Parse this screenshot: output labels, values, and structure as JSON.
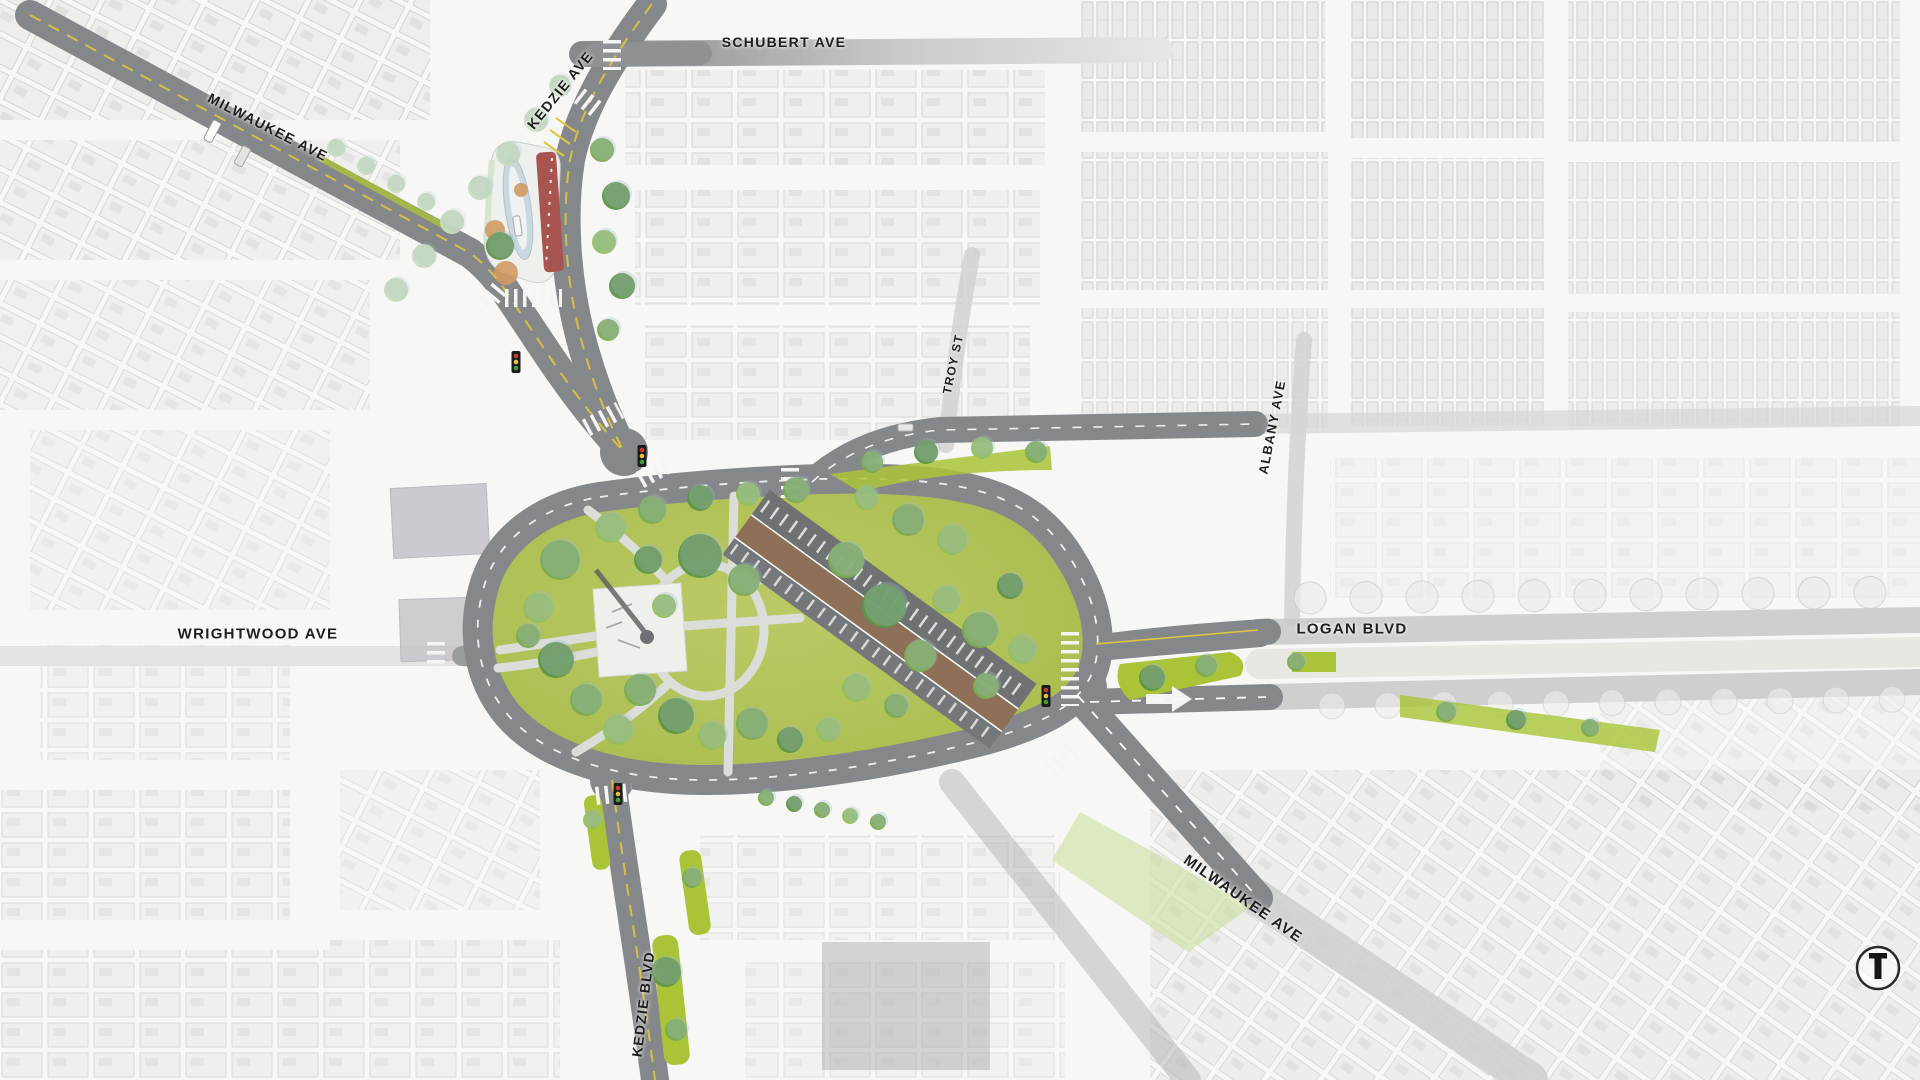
{
  "streets": [
    {
      "id": "schubert-ave",
      "label": "SCHUBERT AVE"
    },
    {
      "id": "kedzie-ave",
      "label": "KEDZIE AVE"
    },
    {
      "id": "milwaukee-ave-nw",
      "label": "MILWAUKEE AVE"
    },
    {
      "id": "troy-st",
      "label": "TROY ST"
    },
    {
      "id": "albany-ave",
      "label": "ALBANY AVE"
    },
    {
      "id": "wrightwood-ave",
      "label": "WRIGHTWOOD AVE"
    },
    {
      "id": "logan-blvd",
      "label": "LOGAN BLVD"
    },
    {
      "id": "milwaukee-ave-se",
      "label": "MILWAUKEE AVE"
    },
    {
      "id": "kedzie-blvd",
      "label": "KEDZIE BLVD"
    }
  ],
  "colors": {
    "road": "#85888a",
    "park_grass": "#afc153",
    "median_grass": "#a9c437",
    "tree_dark": "#5f9447",
    "tree_mid": "#7cab52",
    "tree_light": "#94bf5e",
    "tree_pale": "#c9dcc0",
    "canopy_tint": "#9fbac8",
    "paseo_brown": "#8d7057",
    "plaza_white": "#eef0ec",
    "station_blue": "#c9d8e0",
    "transit_red": "#a85450",
    "planter_orange": "#d09a62",
    "lane_yellow": "#e0c53e",
    "marking_white": "#fafafa"
  }
}
